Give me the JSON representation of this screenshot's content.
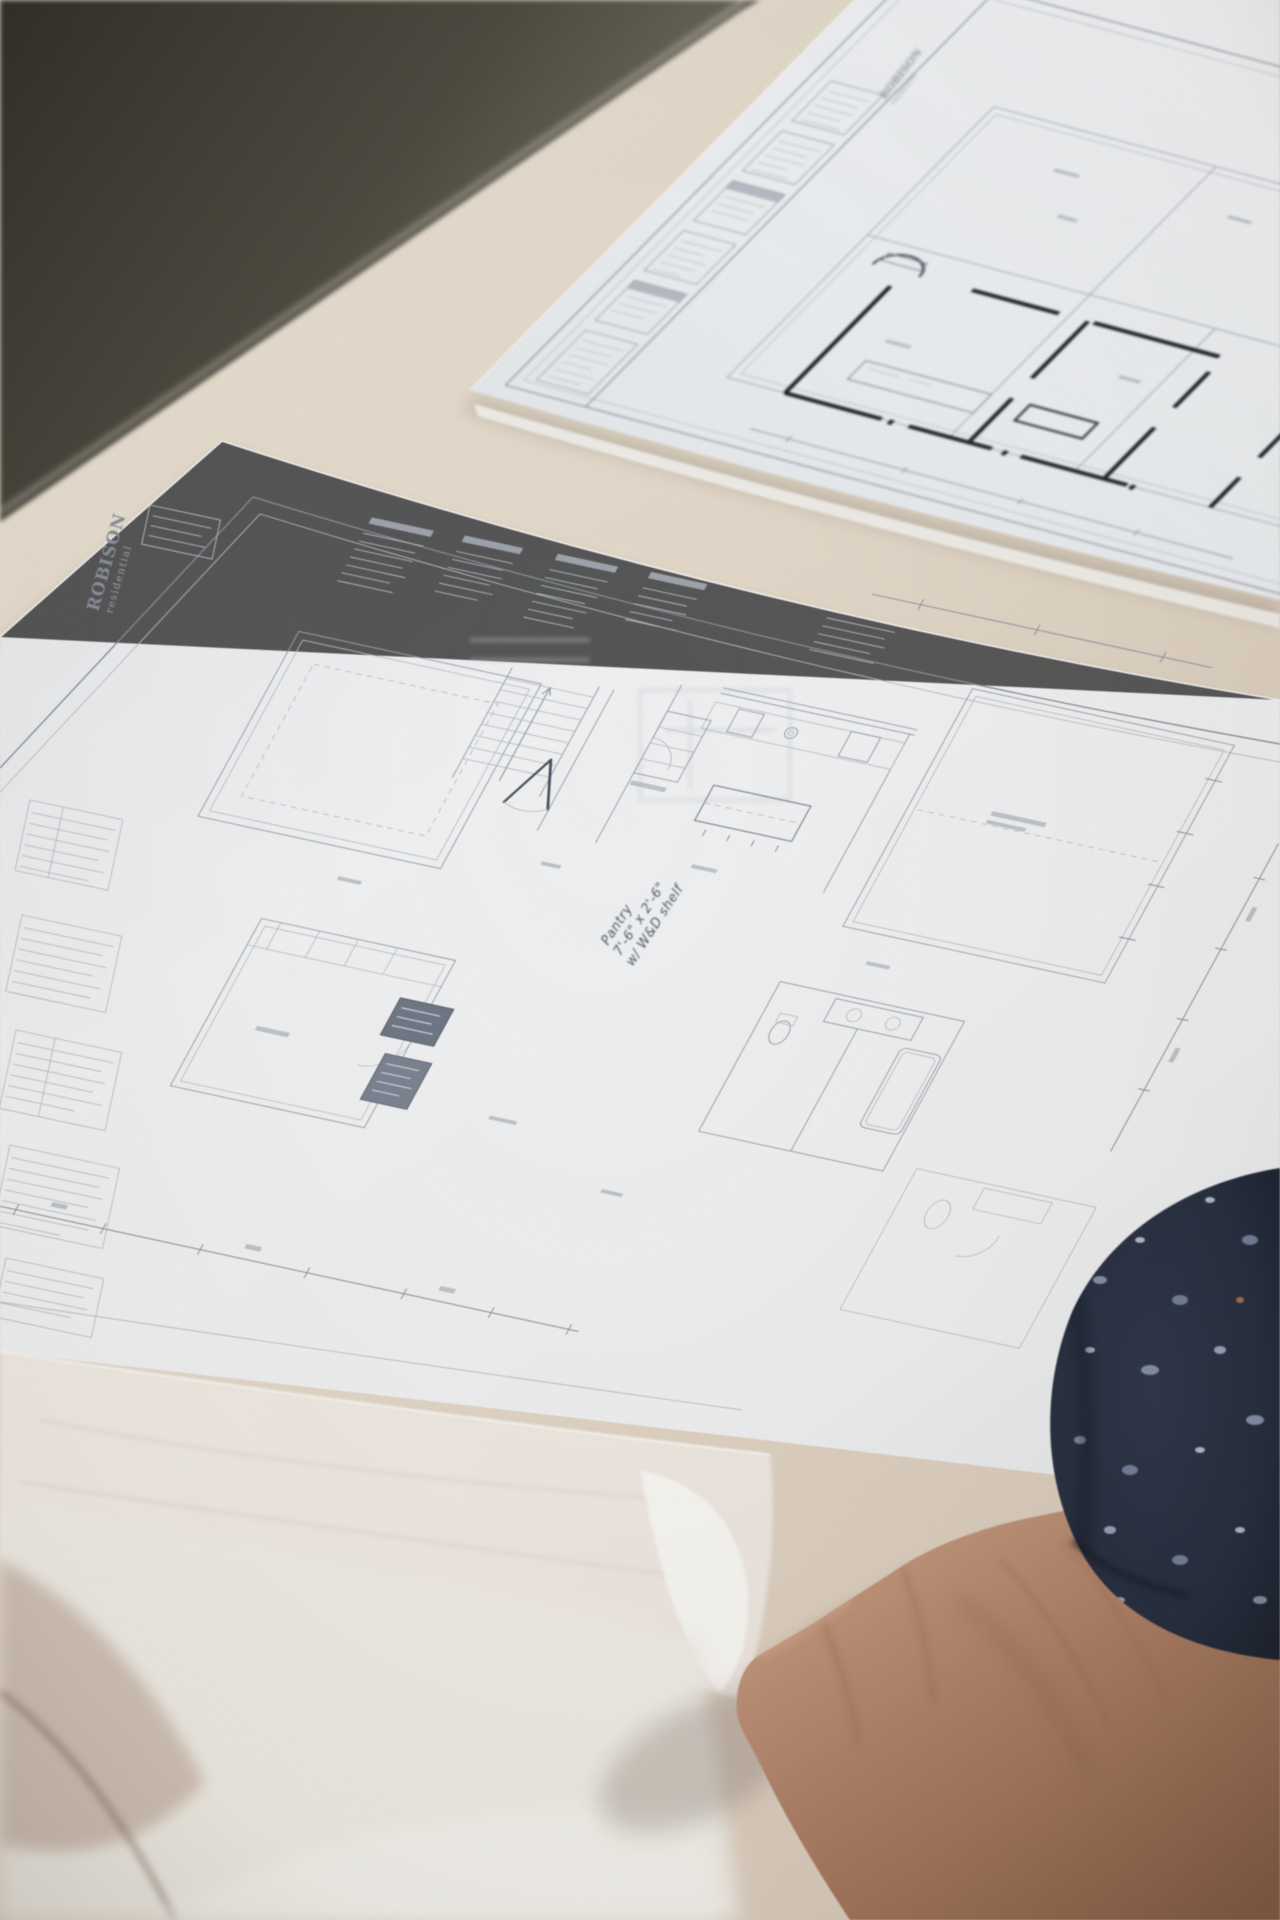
{
  "front_sheet": {
    "logo_line1": "ROBISON",
    "logo_line2": "residential",
    "handwritten_note": {
      "line1": "Pantry",
      "line2": "7'-6\" x 2'-6\"",
      "line3": "w/ W&D shelf"
    }
  },
  "back_sheet": {
    "logo_line1": "ROBISON",
    "logo_line2": "residential"
  },
  "palette": {
    "carpet_dark": "#35332b",
    "carpet_light": "#7b786d",
    "table_beige": "#e5dbcc",
    "table_pink": "#cfbfb1",
    "paper_front": "#f2f3f4",
    "paper_back": "#edf0f3",
    "pencil_line": "#9aa0ab",
    "ink_wall": "#1a1e25",
    "handwriting_ink": "#4e586c",
    "tissue_white": "#faf9f6",
    "skin_light": "#c79b80",
    "skin_mid": "#ab7c63",
    "skin_shadow": "#7e573f",
    "sleeve_navy": "#232a3c",
    "sleeve_speckle": "#93a0b8"
  }
}
